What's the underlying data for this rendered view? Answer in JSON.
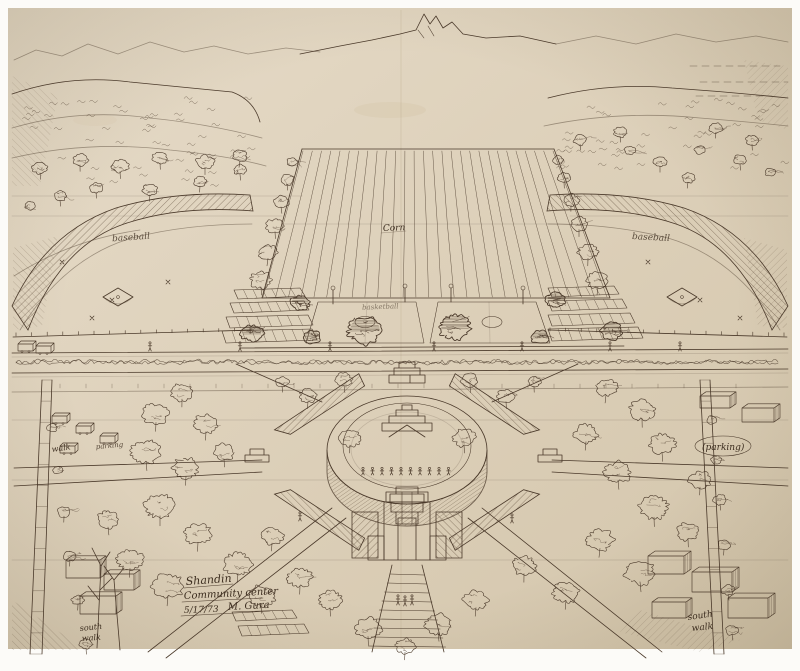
{
  "drawing": {
    "title_block": {
      "project": "Shandin",
      "subtitle": "Community center",
      "date": "5/17/73",
      "signature": "M. Gura"
    },
    "labels": {
      "corn": "Corn",
      "baseball_left": "baseball",
      "baseball_right": "baseball",
      "basketball": "basketball",
      "walk_left": "walk",
      "parking_left": "parking",
      "parking_right": "(parking)",
      "south_left": "south",
      "walk_bottom_left": "walk",
      "south_right": "south",
      "walk_bottom_right": "walk"
    },
    "colors": {
      "paper": "#dfd3be",
      "ink": "#4a392a",
      "background": "#fcfbf8"
    }
  }
}
